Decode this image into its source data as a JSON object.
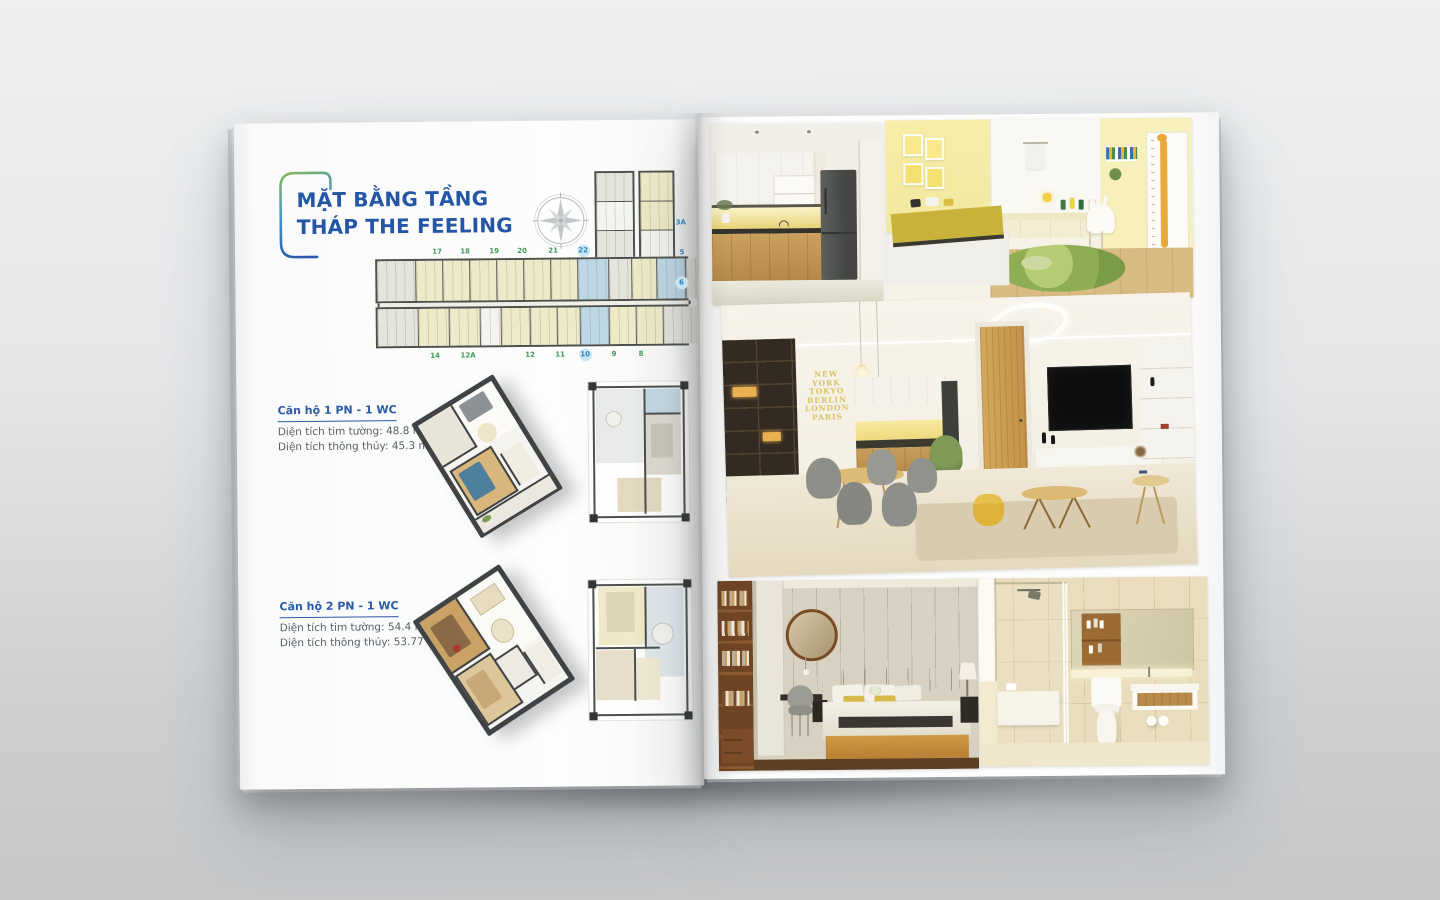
{
  "left_page": {
    "title_line1": "MẶT BẰNG TẦNG",
    "title_line2": "THÁP THE FEELING",
    "floorplan": {
      "top_numbers": [
        "17",
        "18",
        "19",
        "20",
        "21",
        "22"
      ],
      "right_numbers": [
        "3A",
        "5",
        "6"
      ],
      "bottom_numbers": [
        "14",
        "12A",
        "12",
        "11",
        "10",
        "9",
        "8"
      ]
    },
    "units": [
      {
        "name": "Căn hộ 1 PN - 1 WC",
        "area_line1": "Diện tích tim tường: 48.8 m²",
        "area_line2": "Diện tích thông thủy: 45.3 m²",
        "swatch_style": "background:#bfdfe9"
      },
      {
        "name": "Căn hộ 2 PN - 1 WC",
        "area_line1": "Diện tích tim tường: 54.4 m²",
        "area_line2": "Diện tích thông thủy: 53.77 m²",
        "swatch_style": "background:#f0e9bd"
      }
    ],
    "colors": {
      "title_blue": "#2456a5",
      "number_green": "#3f9b55",
      "number_blue": "#2e7fb8",
      "highlight_circle": "#cde8f4"
    }
  },
  "right_page": {
    "photos": [
      "kitchen-render",
      "kids-bedroom-render",
      "living-dining-render",
      "master-bedroom-render",
      "bathroom-render"
    ],
    "living_wall_text": "NEW\nYORK\nTOKYO\nBERLIN\nLONDON\nPARIS"
  }
}
